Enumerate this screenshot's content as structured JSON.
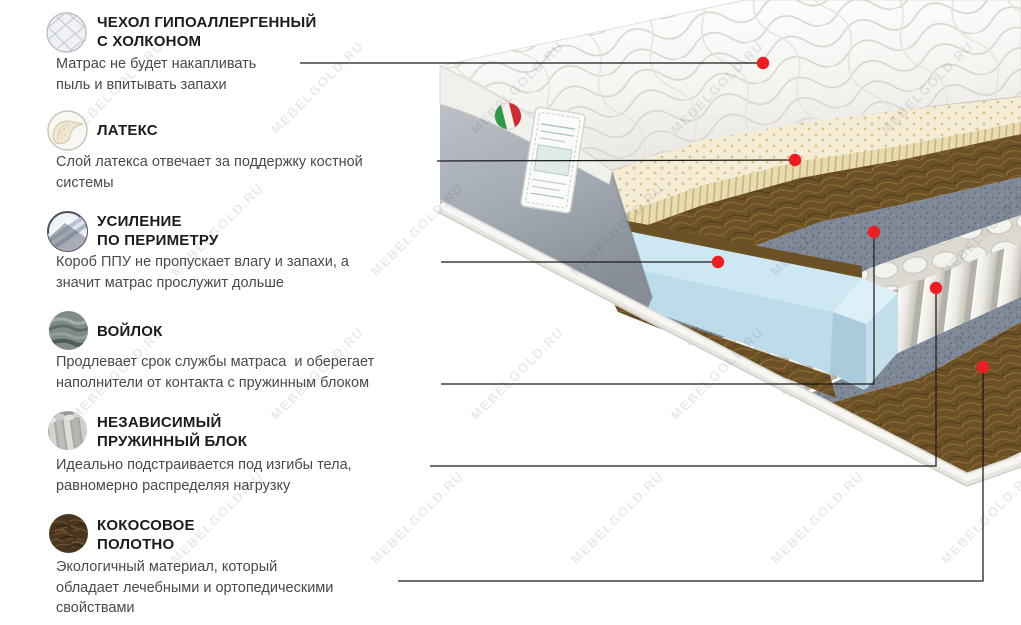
{
  "watermark": {
    "text": "MEBELGOLD.RU"
  },
  "colors": {
    "marker": "#ee1c23",
    "line": "#1b1b1b",
    "latex": "#f4ecd4",
    "coco": "#6d5126",
    "felt": "#7e8795",
    "ppu_blue": "#cde7f3",
    "cover_gray": "#a7adb5"
  },
  "sections": [
    {
      "id": "cover",
      "title": "ЧЕХОЛ ГИПОАЛЛЕРГЕННЫЙ\nС ХОЛКОНОМ",
      "body": "Матрас не будет накапливать\nпыль и впитывать запахи"
    },
    {
      "id": "latex",
      "title": "ЛАТЕКС",
      "body": "Слой латекса отвечает за поддержку костной\nсистемы"
    },
    {
      "id": "perimeter",
      "title": "УСИЛЕНИЕ\nПО ПЕРИМЕТРУ",
      "body": "Короб ППУ не пропускает влагу и запахи, а\nзначит матрас прослужит дольше"
    },
    {
      "id": "felt",
      "title": "ВОЙЛОК",
      "body": "Продлевает срок службы матраса  и оберегает\nнаполнители от контакта с пружинным блоком"
    },
    {
      "id": "springs",
      "title": "НЕЗАВИСИМЫЙ\nПРУЖИННЫЙ БЛОК",
      "body": "Идеально подстраивается под изгибы тела,\nравномерно распределяя нагрузку"
    },
    {
      "id": "coco",
      "title": "КОКОСОВОЕ\nПОЛОТНО",
      "body": "Экологичный материал, который\nобладает лечебными и ортопедическими\nсвойствами"
    }
  ]
}
